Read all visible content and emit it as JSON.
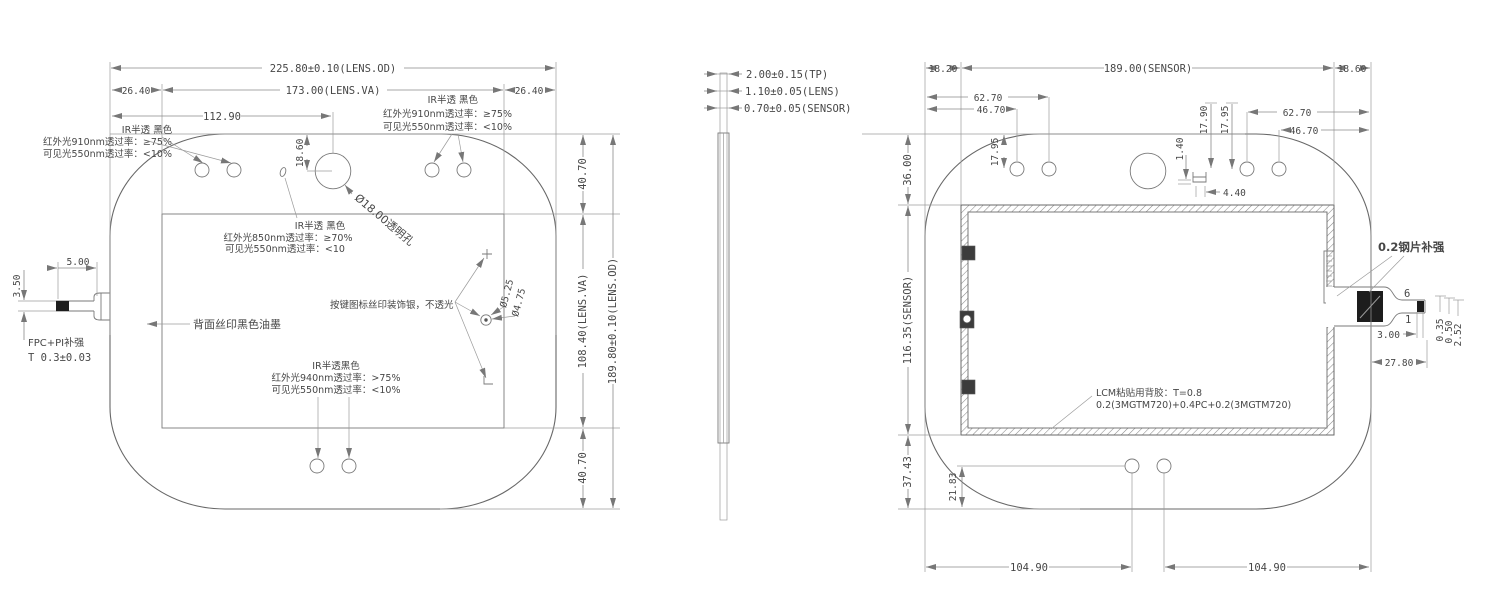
{
  "left_view": {
    "dim_od_w": "225.80±0.10(LENS.OD)",
    "dim_va_w": "173.00(LENS.VA)",
    "dim_margin_l": "26.40",
    "dim_margin_r": "26.40",
    "dim_cam_x": "112.90",
    "dim_cam_y": "18.60",
    "dim_va_top": "40.70",
    "dim_va_h": "108.40(LENS.VA)",
    "dim_od_h": "189.80±0.10(LENS.OD)",
    "dim_va_bottom": "40.70",
    "dim_fpc_len": "5.00",
    "dim_fpc_w": "3.50",
    "fpc_label": "FPC+PI补强",
    "fpc_thickness": "T 0.3±0.03",
    "cam_hole_label": "Ø18.00透明孔",
    "back_ink_label": "背面丝印黑色油墨",
    "key_icon_label": "按键图标丝印装饰银，不透光",
    "btn_outer": "Ø5.25",
    "btn_inner": "Ø4.75",
    "note_tl": [
      "IR半透 黑色",
      "红外光910nm透过率：≥75%",
      "可见光550nm透过率：<10%"
    ],
    "note_tr": [
      "IR半透 黑色",
      "红外光910nm透过率：≥75%",
      "可见光550nm透过率：<10%"
    ],
    "note_center": [
      "IR半透 黑色",
      "红外光850nm透过率：≥70%",
      "可见光550nm透过率：<10"
    ],
    "note_bottom": [
      "IR半透黑色",
      "红外光940nm透过率：>75%",
      "可见光550nm透过率：<10%"
    ]
  },
  "side_view": {
    "dim_tp": "2.00±0.15(TP)",
    "dim_lens": "1.10±0.05(LENS)",
    "dim_sensor": "0.70±0.05(SENSOR)"
  },
  "right_view": {
    "dim_margin_l": "18.20",
    "dim_sensor_w": "189.00(SENSOR)",
    "dim_margin_r": "18.60",
    "dim_l_hole2": "62.70",
    "dim_l_hole1": "46.70",
    "dim_l_hole_y": "17.95",
    "dim_c_notch_y": "17.90",
    "dim_c_hole_y": "17.95",
    "dim_notch_h": "1.40",
    "dim_notch_w": "4.40",
    "dim_r_hole2": "62.70",
    "dim_r_hole1": "46.70",
    "dim_top": "36.00",
    "dim_sensor_h": "116.35(SENSOR)",
    "dim_bottom": "37.43",
    "dim_bhole_y": "21.83",
    "dim_bhole_l": "104.90",
    "dim_bhole_r": "104.90",
    "steel_label": "0.2钢片补强",
    "pin_first": "6",
    "pin_last": "1",
    "dim_tip_len": "3.00",
    "dim_t1": "0.35",
    "dim_t2": "0.50",
    "dim_t3": "2.52",
    "dim_tail_len": "27.80",
    "lcm_note": [
      "LCM粘贴用背胶：T=0.8",
      "0.2(3MGTM720)+0.4PC+0.2(3MGTM720)"
    ]
  }
}
